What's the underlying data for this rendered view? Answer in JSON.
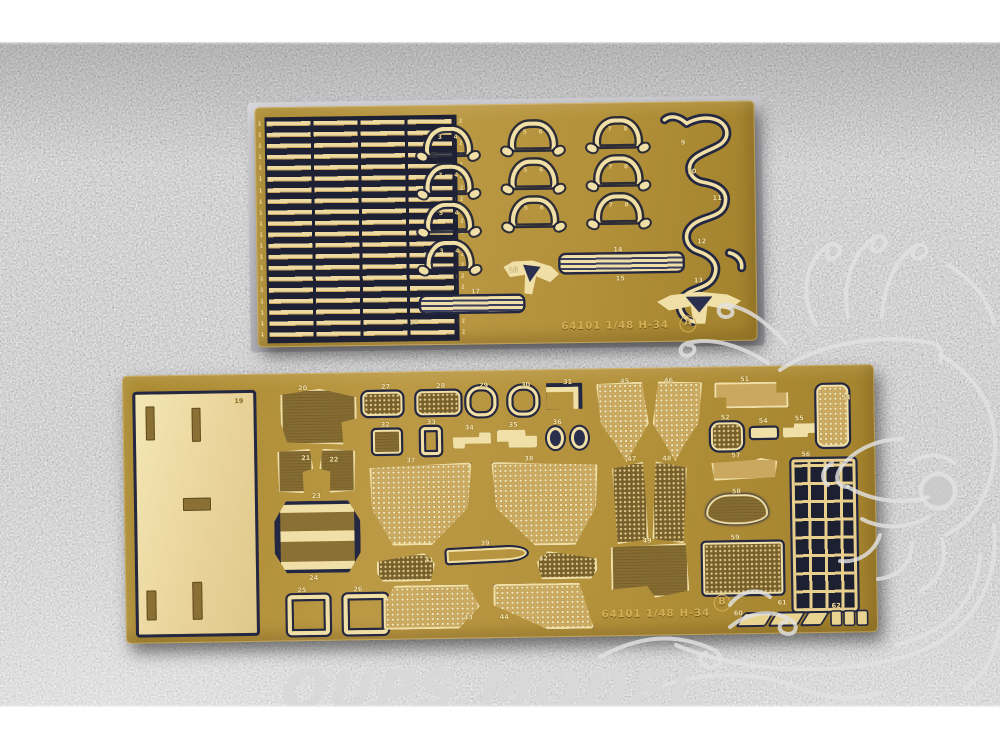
{
  "photo": {
    "description": "Two brass photo-etched model parts frets on dark gray fabric",
    "watermark_text": "OUPS MODEL",
    "colors": {
      "brass": "#b3913b",
      "etched_cream": "#f0dfa6",
      "etch_backing_dark": "#232741",
      "pale_panel": "#ead9a6",
      "dark_panel": "#866c31",
      "carpet": "#4e4e50",
      "film": "#c6c6cb",
      "watermark": "#d8d8d8"
    }
  },
  "sheet_a": {
    "code": "64101 1/48",
    "kit": "H-34",
    "letter": "A",
    "strip_digits_left": "1\n1\n1\n1\n1\n1\n1\n1\n1\n1\n1\n1\n1\n1\n1\n1\n1\n1\n1\n1",
    "strip_digits_right": "2\n2\n2\n2\n2\n2\n2\n2\n2\n2\n2\n2\n2\n2\n2\n2\n2\n2\n2\n2",
    "parts": {
      "n3": "3",
      "n4": "4",
      "n5": "5",
      "n6": "6",
      "n7": "7",
      "n8": "8",
      "n9": "9",
      "n10": "10",
      "n11": "11",
      "n12": "12",
      "n13": "13",
      "n14": "14",
      "n15": "15",
      "n16": "16",
      "n17": "17",
      "n18": "18"
    }
  },
  "sheet_b": {
    "code": "64101 1/48",
    "kit": "H-34",
    "letter": "B",
    "parts": {
      "n19": "19",
      "n20": "20",
      "n21": "21",
      "n22": "22",
      "n23": "23",
      "n24": "24",
      "n25": "25",
      "n26": "26",
      "n27": "27",
      "n28": "28",
      "n29": "29",
      "n30": "30",
      "n31": "31",
      "n32": "32",
      "n33": "33",
      "n34": "34",
      "n35": "35",
      "n36": "36",
      "n37": "37",
      "n38": "38",
      "n39": "39",
      "n41": "41",
      "n42": "42",
      "n43": "43",
      "n44": "44",
      "n45": "45",
      "n46": "46",
      "n47": "47",
      "n48": "48",
      "n49": "49",
      "n51": "51",
      "n52": "52",
      "n53": "53",
      "n54": "54",
      "n55": "55",
      "n56": "56",
      "n57": "57",
      "n58": "58",
      "n59": "59",
      "n60": "60",
      "n61": "61",
      "n62": "62"
    }
  }
}
